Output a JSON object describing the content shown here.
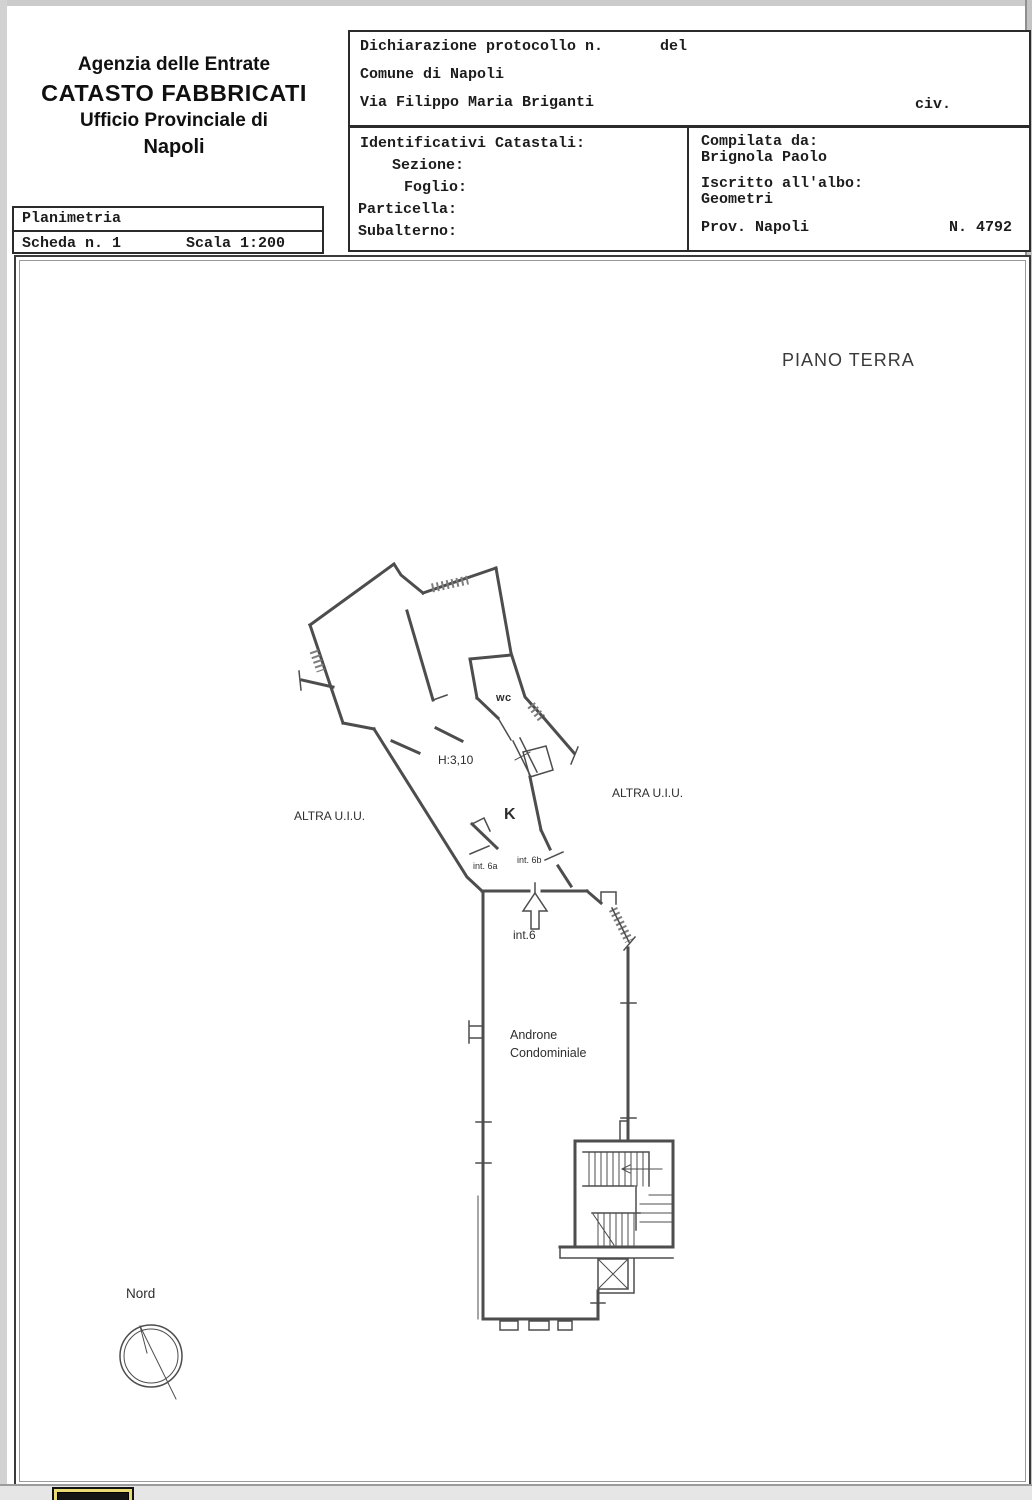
{
  "form": {
    "agency": {
      "line1": "Agenzia delle Entrate",
      "line2": "CATASTO FABBRICATI",
      "line3": "Ufficio Provinciale di",
      "line4": "Napoli"
    },
    "sheet": {
      "title": "Planimetria",
      "scheda": "Scheda n. 1",
      "scala": "Scala 1:200"
    },
    "declaration": {
      "protocol": "Dichiarazione protocollo n.",
      "del": "del",
      "comune": "Comune di Napoli",
      "street": "Via Filippo Maria Briganti",
      "civ": "civ."
    },
    "cadastral": {
      "title": "Identificativi Catastali:",
      "sezione": "Sezione:",
      "foglio": "Foglio:",
      "particella": "Particella:",
      "subalterno": "Subalterno:"
    },
    "compiler": {
      "label": "Compilata da:",
      "name": "Brignola Paolo",
      "albo_label": "Iscritto all'albo:",
      "albo": "Geometri",
      "prov": "Prov. Napoli",
      "num": "N. 4792"
    }
  },
  "plan": {
    "floor_title": "PIANO TERRA",
    "labels": {
      "wc": "wc",
      "height": "H:3,10",
      "kitchen": "K",
      "altra_left": "ALTRA U.I.U.",
      "altra_right": "ALTRA U.I.U.",
      "int_6a": "int. 6a",
      "int_6b": "int. 6b",
      "int_6": "int.6",
      "hall1": "Androne",
      "hall2": "Condominiale",
      "north": "Nord"
    }
  },
  "colors": {
    "wall": "#4d4d4d",
    "ink": "#1c1c1c",
    "accent_icon": "#e8da74"
  }
}
